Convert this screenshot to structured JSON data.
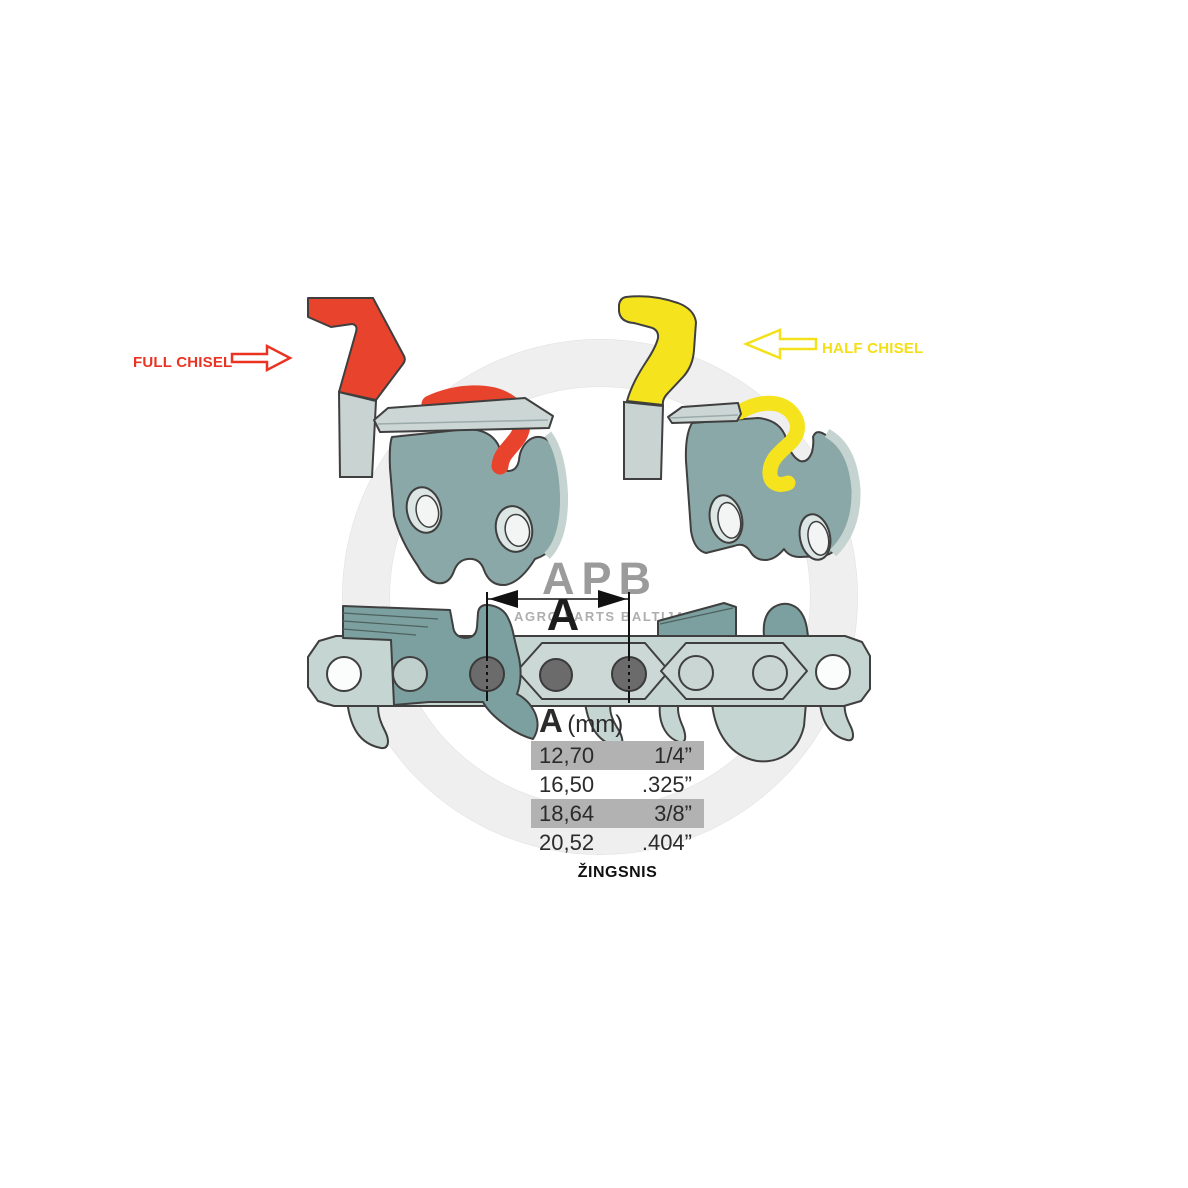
{
  "labels": {
    "full_chisel": "FULL CHISEL",
    "half_chisel": "HALF CHISEL"
  },
  "dimension": {
    "label": "A"
  },
  "pitch_table": {
    "header": {
      "letter": "A",
      "unit": "(mm)"
    },
    "rows": [
      {
        "mm": "12,70",
        "inches": "1/4”",
        "highlighted": true
      },
      {
        "mm": "16,50",
        "inches": ".325”",
        "highlighted": false
      },
      {
        "mm": "18,64",
        "inches": "3/8”",
        "highlighted": true
      },
      {
        "mm": "20,52",
        "inches": ".404”",
        "highlighted": false
      }
    ],
    "caption": "ŽINGSNIS"
  },
  "watermark": {
    "logo": "APB",
    "tagline": "AGRO PARTS BALTIJA"
  },
  "colors": {
    "full_chisel_accent": "#ea3323",
    "half_chisel_accent": "#f3e11c",
    "cutter_body": "#8aa8a7",
    "cutter_dark": "#7ba09f",
    "chain_light": "#c5d5d1",
    "slab_light": "#ccd6d4",
    "rivet_gray": "#6b6b6b",
    "table_highlight": "#b2b2b2",
    "outline": "#3f3f3f"
  }
}
